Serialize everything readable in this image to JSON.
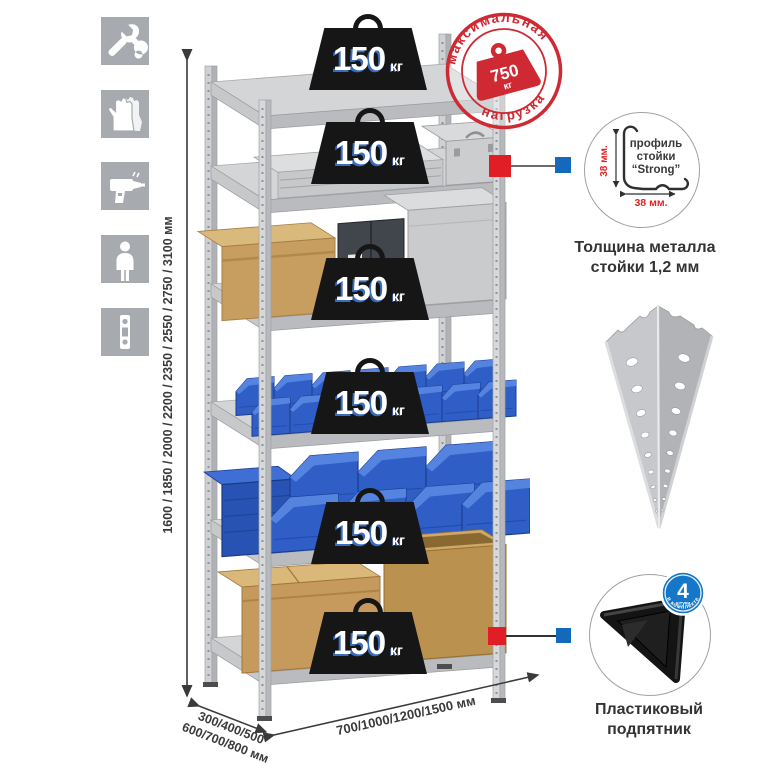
{
  "rack": {
    "shelf_count": 6,
    "shelf_load_value": "150",
    "shelf_load_unit": "кг"
  },
  "stamp": {
    "arc_top": "максимальная",
    "arc_bottom": "нагрузка",
    "weight_value": "750",
    "weight_unit": "кг",
    "color": "#cf2a33"
  },
  "dimensions": {
    "height": "1600 / 1850 / 2000 / 2200 / 2350 / 2550 / 2750 / 3100 мм",
    "depth_line1": "300/400/500",
    "depth_line2": "600/700/800 мм",
    "width": "700/1000/1200/1500 мм"
  },
  "sidebar_icons": [
    {
      "name": "wrench-icon"
    },
    {
      "name": "gloves-icon"
    },
    {
      "name": "drill-icon"
    },
    {
      "name": "person-icon"
    },
    {
      "name": "profile-strip-icon"
    }
  ],
  "profile_detail": {
    "label_line1": "профиль",
    "label_line2": "стойки",
    "label_line3": "“Strong”",
    "vertical_dim": "38 мм.",
    "horizontal_dim": "38 мм.",
    "caption_line1": "Толщина металла",
    "caption_line2": "стойки 1,2 мм"
  },
  "foot_detail": {
    "badge_number": "4",
    "badge_word": "штуки",
    "badge_arc": "в комплекте",
    "caption_line1": "Пластиковый",
    "caption_line2": "подпятник"
  },
  "colors": {
    "icon_gray": "#a7abb0",
    "marker_red": "#e11e26",
    "marker_blue": "#1469bd",
    "badge_blue": "#1477c8",
    "bin_blue": "#2e5ec6",
    "metal_light": "#d3d5d7"
  }
}
